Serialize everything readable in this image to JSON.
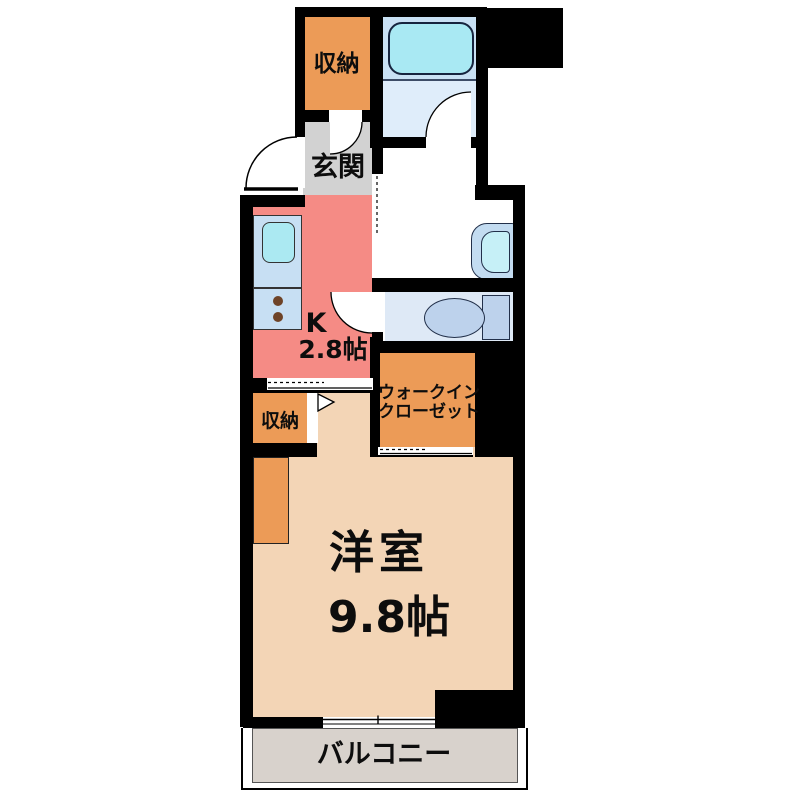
{
  "title": "1K apartment floor plan",
  "labels": {
    "storage_top": "収納",
    "entrance": "玄関",
    "kitchen_abbr": "K",
    "kitchen_size": "2.8帖",
    "wic_line1": "ウォークイン",
    "wic_line2": "クローゼット",
    "storage_mid": "収納",
    "room_name": "洋室",
    "room_size": "9.8帖",
    "balcony": "バルコニー"
  },
  "colors": {
    "wall": "#000000",
    "storage": "#EC9B57",
    "entrance_floor": "#D2D2D2",
    "kitchen": "#F58B85",
    "main_room": "#F3D5B6",
    "balcony": "#D8D2CC",
    "bath_upper": "#C9E1F4",
    "bath_lower": "#DFEDFA",
    "tub": "#A9E9F3",
    "toilet_room": "#DEE9F6",
    "fixture_blue": "#BDD2EC",
    "basin_outer": "#C3DCF1",
    "basin_inner": "#C6F0F7",
    "counter_unit": "#C7DFF3",
    "sink": "#ABE9F2",
    "burner": "#6E4327",
    "counter_orange": "#EC9B57",
    "door_white": "#FFFFFF"
  }
}
